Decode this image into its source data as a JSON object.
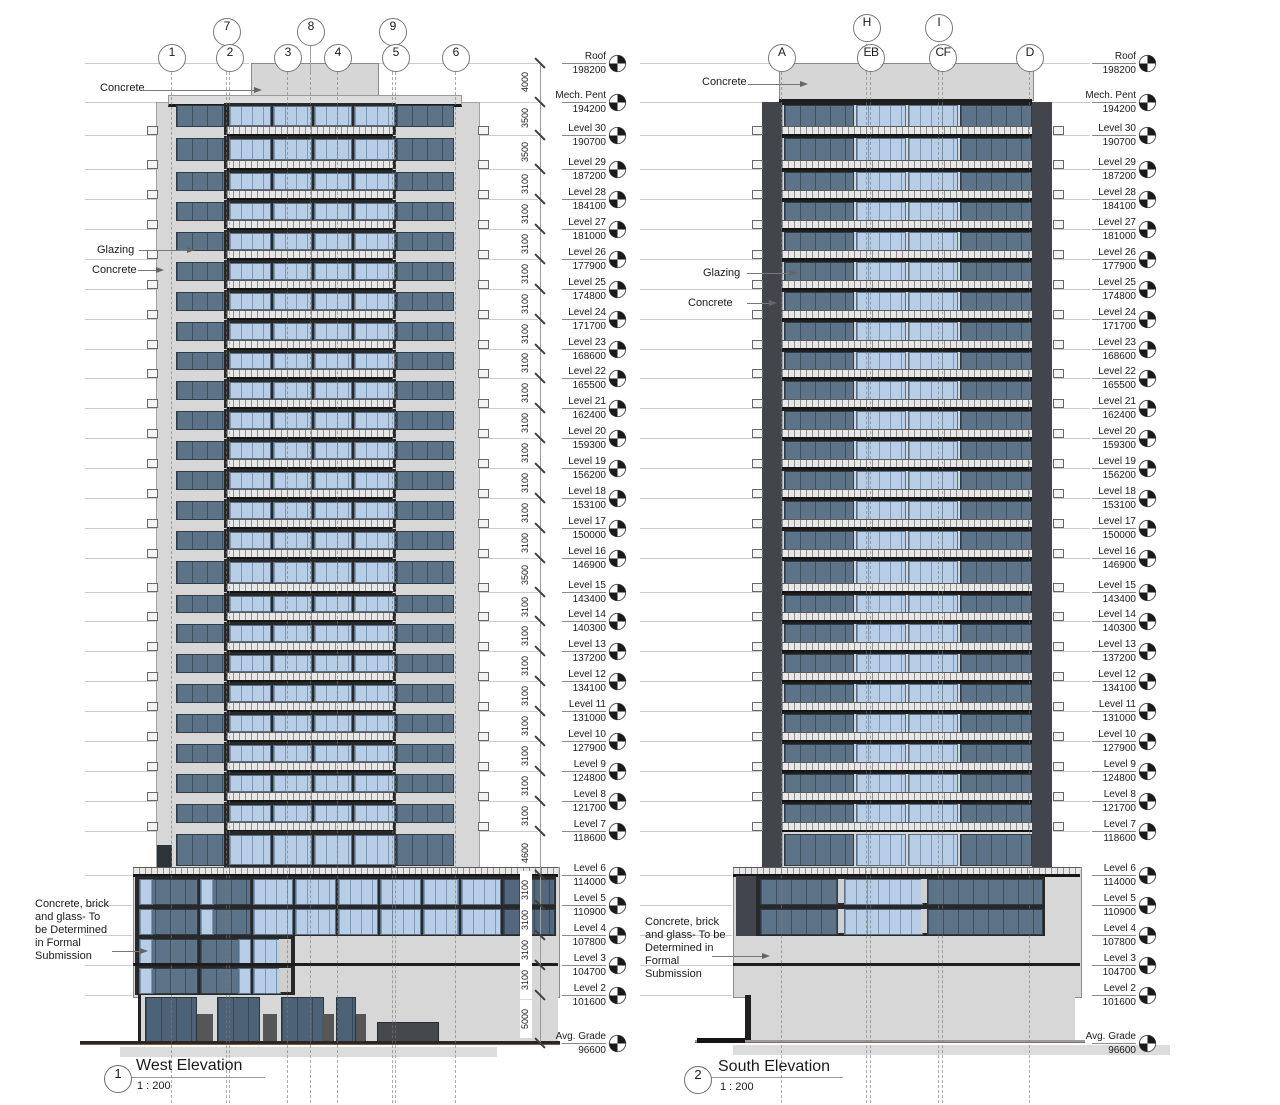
{
  "sheet": {
    "background": "#ffffff"
  },
  "levels": [
    {
      "name": "Roof",
      "elev": 198200,
      "value": "198200"
    },
    {
      "name": "Mech. Pent",
      "elev": 194200,
      "value": "194200"
    },
    {
      "name": "Level 30",
      "elev": 190700,
      "value": "190700"
    },
    {
      "name": "Level 29",
      "elev": 187200,
      "value": "187200"
    },
    {
      "name": "Level 28",
      "elev": 184100,
      "value": "184100"
    },
    {
      "name": "Level 27",
      "elev": 181000,
      "value": "181000"
    },
    {
      "name": "Level 26",
      "elev": 177900,
      "value": "177900"
    },
    {
      "name": "Level 25",
      "elev": 174800,
      "value": "174800"
    },
    {
      "name": "Level 24",
      "elev": 171700,
      "value": "171700"
    },
    {
      "name": "Level 23",
      "elev": 168600,
      "value": "168600"
    },
    {
      "name": "Level 22",
      "elev": 165500,
      "value": "165500"
    },
    {
      "name": "Level 21",
      "elev": 162400,
      "value": "162400"
    },
    {
      "name": "Level 20",
      "elev": 159300,
      "value": "159300"
    },
    {
      "name": "Level 19",
      "elev": 156200,
      "value": "156200"
    },
    {
      "name": "Level 18",
      "elev": 153100,
      "value": "153100"
    },
    {
      "name": "Level 17",
      "elev": 150000,
      "value": "150000"
    },
    {
      "name": "Level 16",
      "elev": 146900,
      "value": "146900"
    },
    {
      "name": "Level 15",
      "elev": 143400,
      "value": "143400"
    },
    {
      "name": "Level 14",
      "elev": 140300,
      "value": "140300"
    },
    {
      "name": "Level 13",
      "elev": 137200,
      "value": "137200"
    },
    {
      "name": "Level 12",
      "elev": 134100,
      "value": "134100"
    },
    {
      "name": "Level 11",
      "elev": 131000,
      "value": "131000"
    },
    {
      "name": "Level 10",
      "elev": 127900,
      "value": "127900"
    },
    {
      "name": "Level 9",
      "elev": 124800,
      "value": "124800"
    },
    {
      "name": "Level 8",
      "elev": 121700,
      "value": "121700"
    },
    {
      "name": "Level 7",
      "elev": 118600,
      "value": "118600"
    },
    {
      "name": "Level 6",
      "elev": 114000,
      "value": "114000"
    },
    {
      "name": "Level 5",
      "elev": 110900,
      "value": "110900"
    },
    {
      "name": "Level 4",
      "elev": 107800,
      "value": "107800"
    },
    {
      "name": "Level 3",
      "elev": 104700,
      "value": "104700"
    },
    {
      "name": "Level 2",
      "elev": 101600,
      "value": "101600"
    },
    {
      "name": "Avg. Grade",
      "elev": 96600,
      "value": "96600"
    }
  ],
  "dims": [
    {
      "text": "4000",
      "boxed": false
    },
    {
      "text": "3500",
      "boxed": false
    },
    {
      "text": "3500",
      "boxed": false
    },
    {
      "text": "3100",
      "boxed": false
    },
    {
      "text": "3100",
      "boxed": false
    },
    {
      "text": "3100",
      "boxed": false
    },
    {
      "text": "3100",
      "boxed": false
    },
    {
      "text": "3100",
      "boxed": false
    },
    {
      "text": "3100",
      "boxed": false
    },
    {
      "text": "3100",
      "boxed": false
    },
    {
      "text": "3100",
      "boxed": false
    },
    {
      "text": "3100",
      "boxed": false
    },
    {
      "text": "3100",
      "boxed": false
    },
    {
      "text": "3100",
      "boxed": false
    },
    {
      "text": "3100",
      "boxed": false
    },
    {
      "text": "3100",
      "boxed": false
    },
    {
      "text": "3500",
      "boxed": false
    },
    {
      "text": "3100",
      "boxed": false
    },
    {
      "text": "3100",
      "boxed": false
    },
    {
      "text": "3100",
      "boxed": false
    },
    {
      "text": "3100",
      "boxed": false
    },
    {
      "text": "3100",
      "boxed": false
    },
    {
      "text": "3100",
      "boxed": false
    },
    {
      "text": "3100",
      "boxed": false
    },
    {
      "text": "3100",
      "boxed": false
    },
    {
      "text": "4600",
      "boxed": false
    },
    {
      "text": "3100",
      "boxed": true
    },
    {
      "text": "3100",
      "boxed": true
    },
    {
      "text": "3100",
      "boxed": true
    },
    {
      "text": "3100",
      "boxed": true
    },
    {
      "text": "5000",
      "boxed": true
    }
  ],
  "west": {
    "viewNumber": "1",
    "title": "West Elevation",
    "scale": "1 : 200",
    "bubblesUpper": [
      {
        "label": "7",
        "x": 226
      },
      {
        "label": "8",
        "x": 310
      },
      {
        "label": "9",
        "x": 392
      }
    ],
    "bubblesLower": [
      {
        "label": "1",
        "x": 171
      },
      {
        "label": "2",
        "x": 229
      },
      {
        "label": "3",
        "x": 287
      },
      {
        "label": "4",
        "x": 337
      },
      {
        "label": "5",
        "x": 395
      },
      {
        "label": "6",
        "x": 455
      }
    ],
    "gridXs": [
      171,
      226,
      229,
      287,
      310,
      337,
      392,
      395,
      455
    ],
    "ann": {
      "concreteTop": "Concrete",
      "glazing": "Glazing",
      "concreteMid": "Concrete",
      "podiumNote": "Concrete, brick\nand glass- To\nbe Determined\nin Formal\nSubmission"
    }
  },
  "south": {
    "viewNumber": "2",
    "title": "South Elevation",
    "scale": "1 : 200",
    "bubblesUpper": [
      {
        "label": "H",
        "x": 866
      },
      {
        "label": "I",
        "x": 938
      }
    ],
    "bubblesLower": [
      {
        "label": "A",
        "x": 781
      },
      {
        "label": "EB",
        "x": 870
      },
      {
        "label": "CF",
        "x": 942
      },
      {
        "label": "D",
        "x": 1029
      }
    ],
    "gridXs": [
      781,
      866,
      870,
      938,
      942,
      1029
    ],
    "ann": {
      "concreteTop": "Concrete",
      "glazing": "Glazing",
      "concreteMid": "Concrete",
      "podiumNote": "Concrete, brick\nand glass- To be\nDetermined in\nFormal\nSubmission"
    }
  },
  "colors": {
    "concrete": "#d7d7d7",
    "penthouse": "#d6d6d6",
    "frame": "#282828",
    "darkGlass": "#5d7387",
    "lightGlass": "#b7cee6",
    "sideBand": "#42464c",
    "railBg": "#e7e7e7",
    "railTick": "#8f8f8f",
    "line": "#9a9a9a",
    "faint": "#cccccc",
    "grid": "#9f9f9f",
    "text": "#1a1a1a",
    "grade": "#2e2521",
    "shadow": "#dcdcdc",
    "door": "#565656",
    "garage": "#45484d",
    "storefront": "#4e6277"
  }
}
